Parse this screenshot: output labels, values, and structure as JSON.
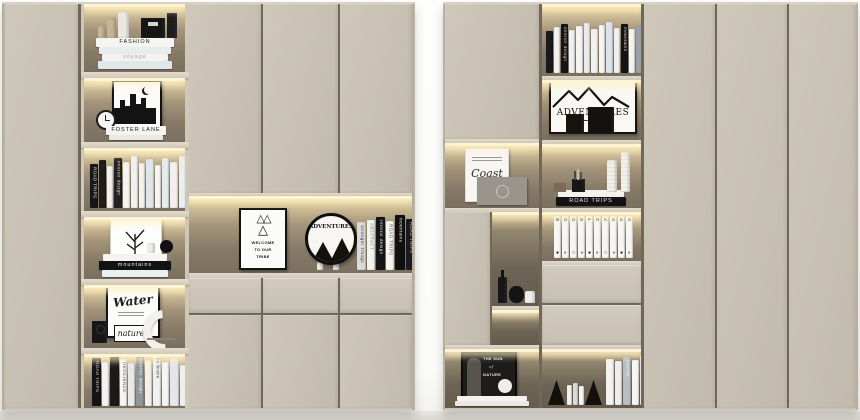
{
  "palette": {
    "panel": "#c9c2b4",
    "panel_light": "#cfc8ba",
    "seam": "#6f6859",
    "niche_glow": "#f5e6b8",
    "niche_back": "#857966",
    "niche_dark": "#6e6455",
    "led": "#fef4d2",
    "shelf_face": "#d9d2c3",
    "black": "#161616",
    "white": "#f5f4f1",
    "floor": "#e0ded9"
  },
  "left_unit": {
    "fashion_stack": [
      {
        "w": 78,
        "h": 9,
        "c": "#f6f5f2",
        "t": "FASHION",
        "tc": "#1b1b1b"
      },
      {
        "w": 72,
        "h": 7,
        "c": "#e7edef"
      },
      {
        "w": 66,
        "h": 7,
        "c": "#f3f2ef",
        "t": "voyage",
        "tc": "#9aa4a8"
      },
      {
        "w": 74,
        "h": 8,
        "c": "#dfe7ea"
      }
    ],
    "foster_stack": [
      {
        "w": 60,
        "h": 9,
        "c": "#f5f4f1",
        "t": "FOSTER LANE",
        "tc": "#141414"
      },
      {
        "w": 54,
        "h": 5,
        "c": "#e9e8e5"
      }
    ],
    "mountain_stack": [
      {
        "w": 64,
        "h": 7,
        "c": "#f4f3f0"
      },
      {
        "w": 72,
        "h": 9,
        "c": "#121212",
        "t": "mountains",
        "tc": "#f2f2f2"
      },
      {
        "w": 66,
        "h": 7,
        "c": "#eceff0"
      }
    ],
    "row3_books": [
      {
        "w": 8,
        "h": 44,
        "c": "#17171a",
        "t": "ROAD TRIPS",
        "tc": "#e8e8e8"
      },
      {
        "w": 7,
        "h": 48,
        "c": "#1f1d1c"
      },
      {
        "w": 6,
        "h": 42,
        "c": "#f2f1ee"
      },
      {
        "w": 8,
        "h": 50,
        "c": "#24221f",
        "t": "interior design",
        "tc": "#dddddd"
      },
      {
        "w": 7,
        "h": 46,
        "c": "#f5f4f1"
      },
      {
        "w": 7,
        "h": 52,
        "c": "#eef0f1"
      },
      {
        "w": 6,
        "h": 45,
        "c": "#f3f2ef"
      },
      {
        "w": 8,
        "h": 49,
        "c": "#dfe6e9"
      },
      {
        "w": 6,
        "h": 43,
        "c": "#f6f5f2"
      },
      {
        "w": 7,
        "h": 50,
        "c": "#e7ebed"
      },
      {
        "w": 8,
        "h": 46,
        "c": "#f1f0ed"
      },
      {
        "w": 7,
        "h": 52,
        "c": "#eaeef0"
      }
    ],
    "row6_books": [
      {
        "w": 9,
        "h": 48,
        "c": "#141416",
        "t": "ROAD TRIPS",
        "tc": "#dddddd"
      },
      {
        "w": 7,
        "h": 44,
        "c": "#f3f2ef"
      },
      {
        "w": 9,
        "h": 52,
        "c": "#1c1a19"
      },
      {
        "w": 7,
        "h": 47,
        "c": "#f5f4f1",
        "t": "RESILIENCE",
        "tc": "#555555"
      },
      {
        "w": 7,
        "h": 43,
        "c": "#ebe9e5"
      },
      {
        "w": 8,
        "h": 50,
        "c": "#90979a",
        "t": "interior design",
        "tc": "#f2f2f2"
      },
      {
        "w": 7,
        "h": 46,
        "c": "#f2f1ee"
      },
      {
        "w": 8,
        "h": 51,
        "c": "#eef0f1",
        "t": "be brave",
        "tc": "#444455"
      },
      {
        "w": 7,
        "h": 44,
        "c": "#f6f5f2"
      },
      {
        "w": 9,
        "h": 48,
        "c": "#e3e7e9"
      },
      {
        "w": 7,
        "h": 41,
        "c": "#f0efec"
      }
    ],
    "water_art": {
      "title": "Water",
      "subtitle": "nature"
    },
    "center": {
      "poster": {
        "glyphs": "△△",
        "glyph2": "△",
        "l1": "WELCOME",
        "l2": "TO OUR",
        "l3": "TRIBE"
      },
      "sign": "ADVENTURES",
      "books": [
        {
          "w": 9,
          "h": 48,
          "c": "#d8dbda",
          "t": "Stranger Things",
          "tc": "#444444"
        },
        {
          "w": 8,
          "h": 50,
          "c": "#f4f3f0",
          "t": "ABSTRACT",
          "tc": "#777777"
        },
        {
          "w": 9,
          "h": 53,
          "c": "#161616",
          "t": "Interior design",
          "tc": "#e9e9e9"
        },
        {
          "w": 8,
          "h": 49,
          "c": "#f6f5f2",
          "t": "ROAD TRIPS",
          "tc": "#555555"
        },
        {
          "w": 10,
          "h": 55,
          "c": "#101011",
          "t": "mountains",
          "tc": "#f1f1f1"
        },
        {
          "w": 9,
          "h": 51,
          "c": "#1b1b1d",
          "t": "ROAD TRIPS",
          "tc": "#cfcfcf"
        }
      ]
    }
  },
  "right_unit": {
    "magazine": {
      "script": "Coast"
    },
    "top_books": [
      {
        "w": 7,
        "h": 42,
        "c": "#19191b"
      },
      {
        "w": 6,
        "h": 46,
        "c": "#f3f2ef"
      },
      {
        "w": 7,
        "h": 49,
        "c": "#151517",
        "t": "interior design",
        "tc": "#cccccc"
      },
      {
        "w": 6,
        "h": 43,
        "c": "#eef0f1"
      },
      {
        "w": 7,
        "h": 47,
        "c": "#f5f4f1"
      },
      {
        "w": 6,
        "h": 50,
        "c": "#e8ecee"
      },
      {
        "w": 7,
        "h": 44,
        "c": "#f2f1ee"
      },
      {
        "w": 6,
        "h": 48,
        "c": "#f6f5f2"
      },
      {
        "w": 7,
        "h": 51,
        "c": "#dde3e6"
      },
      {
        "w": 6,
        "h": 45,
        "c": "#f1f0ed"
      },
      {
        "w": 7,
        "h": 49,
        "c": "#131315",
        "t": "mountains",
        "tc": "#dddddd"
      },
      {
        "w": 6,
        "h": 44,
        "c": "#f4f3f0"
      },
      {
        "w": 7,
        "h": 47,
        "c": "#9aa0a3"
      },
      {
        "w": 6,
        "h": 42,
        "c": "#efeeeb"
      }
    ],
    "adventure_art": {
      "title": "ADVENTURES"
    },
    "vase_stack": [
      {
        "w": 66,
        "h": 7,
        "c": "#f2f1ee"
      },
      {
        "w": 70,
        "h": 9,
        "c": "#131313",
        "t": "ROAD TRIPS",
        "tc": "#e8e8e8"
      }
    ],
    "moon_books": [
      {
        "w": 7,
        "h": 42,
        "t": "M",
        "p": "●"
      },
      {
        "w": 7,
        "h": 42,
        "t": "O",
        "p": "◐"
      },
      {
        "w": 7,
        "h": 42,
        "t": "O",
        "p": "○"
      },
      {
        "w": 7,
        "h": 42,
        "t": "N",
        "p": "◑"
      },
      {
        "w": 7,
        "h": 42,
        "t": "P",
        "p": "●"
      },
      {
        "w": 7,
        "h": 42,
        "t": "H",
        "p": "◐"
      },
      {
        "w": 7,
        "h": 42,
        "t": "A",
        "p": "○"
      },
      {
        "w": 7,
        "h": 42,
        "t": "S",
        "p": "◑"
      },
      {
        "w": 7,
        "h": 42,
        "t": "E",
        "p": "●"
      },
      {
        "w": 7,
        "h": 42,
        "t": "S",
        "p": "◐"
      }
    ],
    "poster": {
      "l1": "THE SUN",
      "l2": "of",
      "l3": "NATURE"
    },
    "poster_stack": [
      {
        "w": 70,
        "h": 5,
        "c": "#f4f3f0"
      },
      {
        "w": 74,
        "h": 5,
        "c": "#e8e7e4"
      }
    ],
    "bookend_books": [
      {
        "w": 5,
        "h": 20,
        "c": "#f2f1ee"
      },
      {
        "w": 5,
        "h": 22,
        "c": "#d9dcde"
      },
      {
        "w": 5,
        "h": 19,
        "c": "#f6f5f2"
      }
    ],
    "bottom_books": [
      {
        "w": 8,
        "h": 46,
        "c": "#f4f3f0"
      },
      {
        "w": 7,
        "h": 44,
        "c": "#eceff1"
      },
      {
        "w": 8,
        "h": 48,
        "c": "#b9bec2",
        "t": "interior",
        "tc": "#f3f3f3"
      },
      {
        "w": 7,
        "h": 45,
        "c": "#f6f5f2"
      },
      {
        "w": 8,
        "h": 50,
        "c": "#e2e6e8"
      },
      {
        "w": 7,
        "h": 43,
        "c": "#f1f0ed"
      }
    ]
  }
}
